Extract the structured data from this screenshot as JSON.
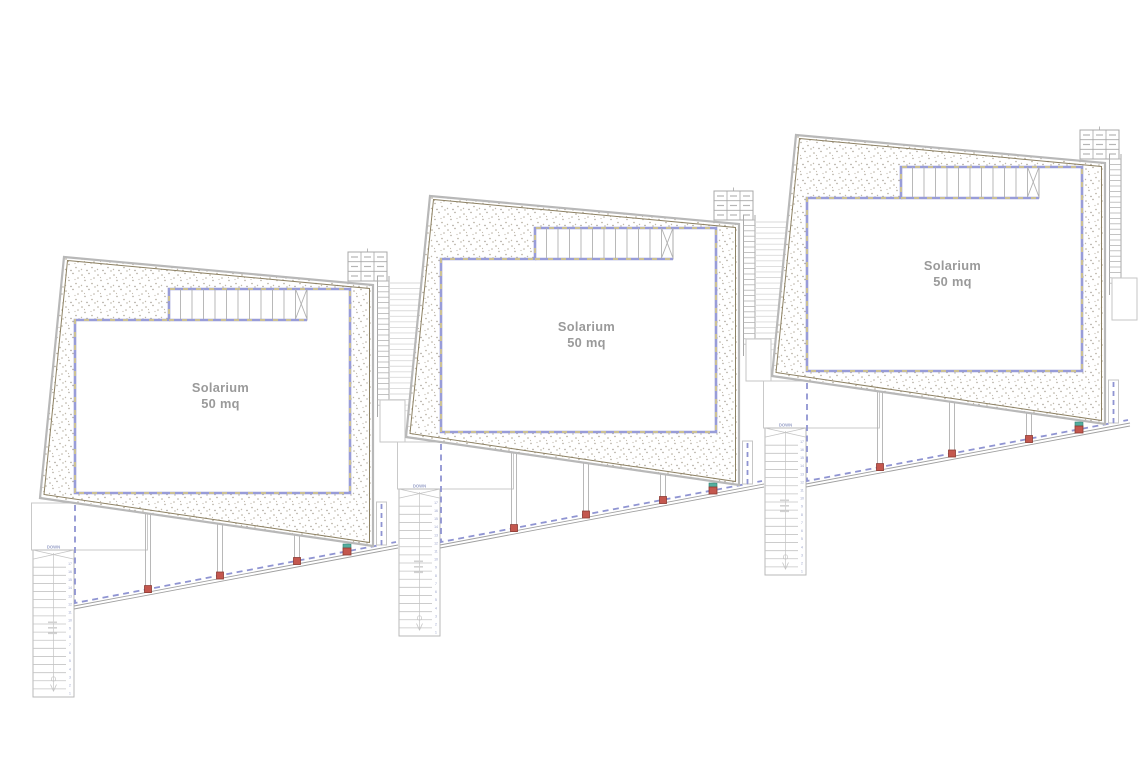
{
  "drawing": {
    "kind": "architectural roof plan",
    "background": "#ffffff"
  },
  "units": [
    {
      "id": "unit-1",
      "solarium_label": "Solarium",
      "area_label": "50 mq",
      "stair_label": "DOWN",
      "stair_step_count": 17
    },
    {
      "id": "unit-2",
      "solarium_label": "Solarium",
      "area_label": "50 mq",
      "stair_label": "DOWN",
      "stair_step_count": 17
    },
    {
      "id": "unit-3",
      "solarium_label": "Solarium",
      "area_label": "50 mq",
      "stair_label": "DOWN",
      "stair_step_count": 17
    }
  ],
  "colors": {
    "band_blue": "#989cd8",
    "band_tan": "#ccc193",
    "dash_blue": "#8f94d2",
    "outline_gray": "#b8b8b8",
    "outline_olive": "#8d8163",
    "line_gray": "#b0b0b0",
    "light_gray": "#c9c9c9",
    "terrain_gray": "#dadada",
    "marker_red": "#c4574e",
    "marker_red_border": "#8d3a33",
    "marker_teal": "#53ae9f",
    "label_gray": "#9a9a9a",
    "stair_text_blue": "#97a0c8"
  }
}
